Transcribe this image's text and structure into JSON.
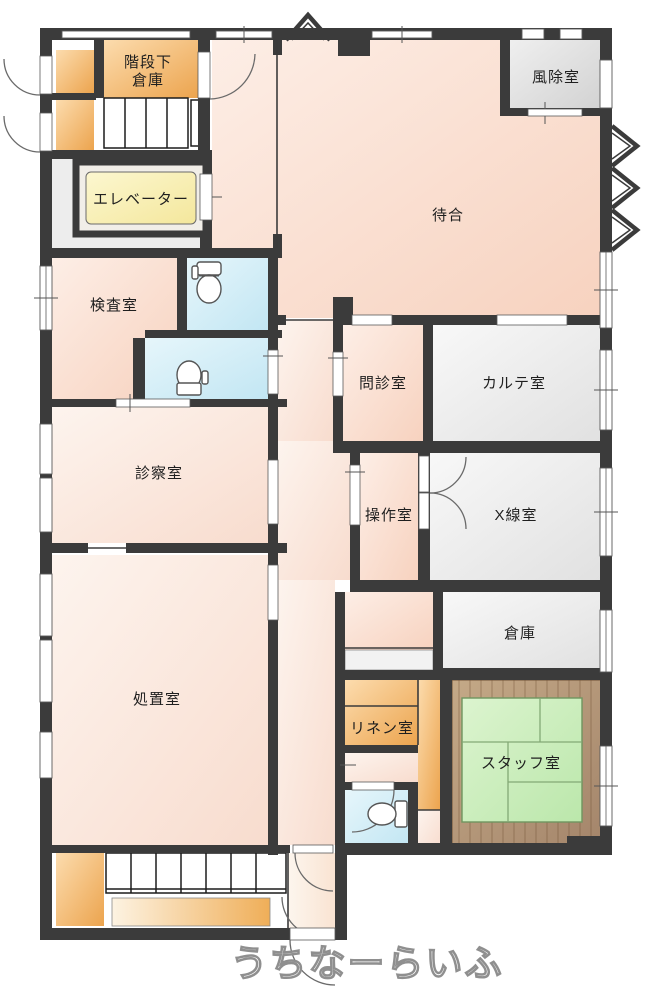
{
  "rooms": {
    "under_stairs_storage_line1": "階段下",
    "under_stairs_storage_line2": "倉庫",
    "windbreak": "風除室",
    "elevator": "エレベーター",
    "waiting": "待合",
    "exam": "検査室",
    "interview": "問診室",
    "records": "カルテ室",
    "consult": "診察室",
    "control": "操作室",
    "xray": "X線室",
    "treatment": "処置室",
    "storage": "倉庫",
    "linen": "リネン室",
    "staff": "スタッフ室"
  },
  "watermark": "うちなーらいふ",
  "colors": {
    "wall": "#3b3b3b",
    "room_pink": "#f8d7c5",
    "room_pink_light": "#fcece3",
    "room_gray": "#e9e9e9",
    "accent_orange": "#efae5c",
    "elevator_yellow": "#f8efae",
    "toilet_blue": "#cdeaf6",
    "tatami_green": "#c9ecbb",
    "wood_brown": "#b59a7c"
  }
}
